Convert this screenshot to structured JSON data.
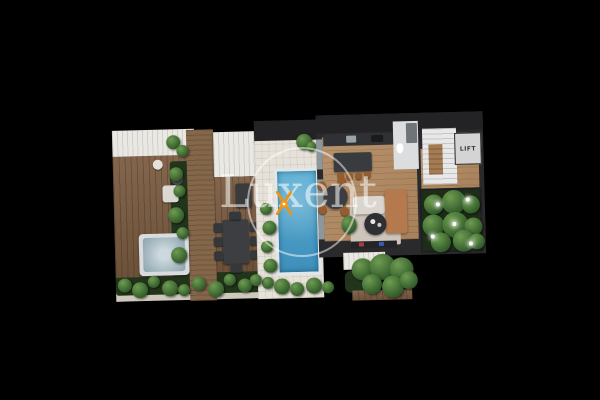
{
  "watermark": {
    "brand_text": "Luxent",
    "logo_icon": "luxent-x-monogram",
    "logo_color": "#f2920f"
  },
  "floorplan": {
    "lift_label": "LIFT"
  },
  "colors": {
    "background": "#000000",
    "deck_wood": "#7b5c41",
    "walkway_wood": "#84664a",
    "interior_wood": "#b28960",
    "pergola_white": "#eae8e3",
    "paving": "#e7e2d9",
    "pool_water_light": "#58aed4",
    "pool_water_dark": "#3e8fba",
    "pool_rim": "#dfe7e9",
    "wall_dark": "#2a2a2d",
    "roof_dark": "#232326",
    "greenery_base": "#22351b",
    "bush_light": "#6f9b52",
    "bush_mid": "#3f6b33",
    "bush_dark": "#27451f",
    "lift_room": "#d4d4d4",
    "stairs_white": "#e8e8e8",
    "hot_tub_frame": "#d8dcde",
    "hot_tub_water": "#a9bcc4",
    "sofa_light": "#dad6cf",
    "chaise_terracotta": "#b5794e",
    "rug": "#cdc5ba",
    "furniture_dark": "#3c3e41",
    "chair_brown": "#935c31",
    "path_light": "#cfc9bd",
    "watermark_white": "rgba(255,255,255,0.55)"
  }
}
